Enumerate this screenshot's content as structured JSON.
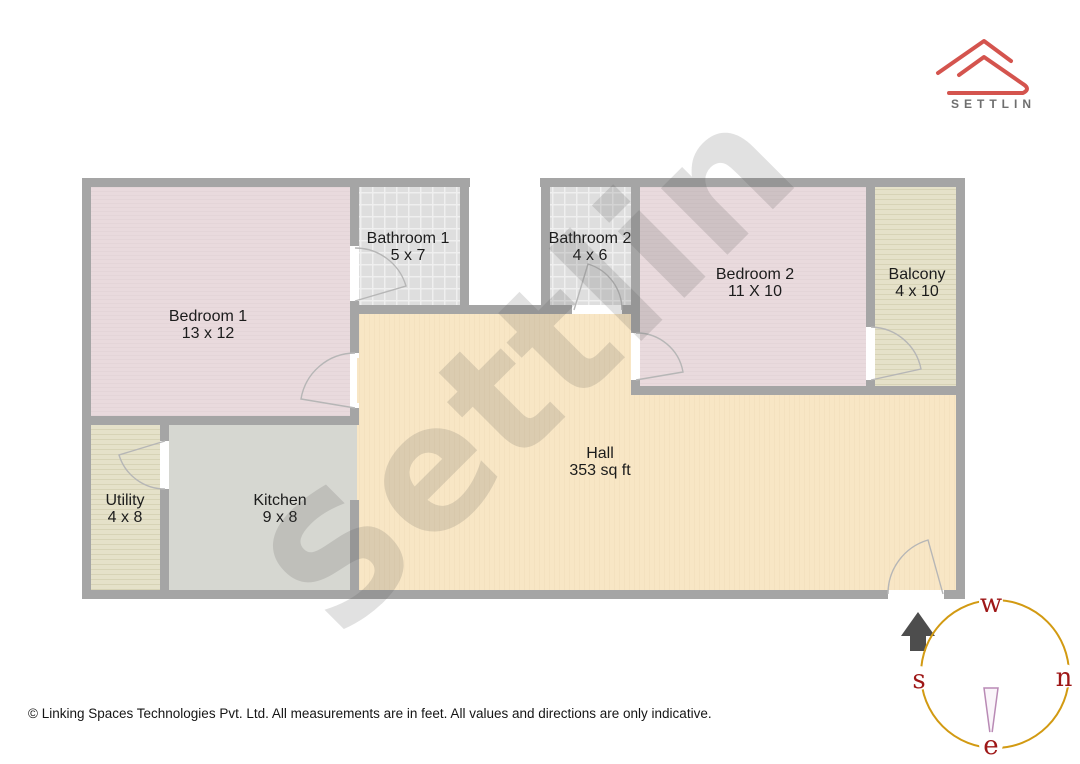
{
  "brand": {
    "name": "SETTLIN"
  },
  "watermark": {
    "text": "Settlin"
  },
  "floorplan": {
    "rooms": [
      {
        "name": "Bedroom 1",
        "dims": "13 x 12"
      },
      {
        "name": "Bathroom 1",
        "dims": "5 x 7"
      },
      {
        "name": "Bathroom 2",
        "dims": "4 x 6"
      },
      {
        "name": "Bedroom 2",
        "dims": "11 X 10"
      },
      {
        "name": "Balcony",
        "dims": "4 x 10"
      },
      {
        "name": "Utility",
        "dims": "4 x 8"
      },
      {
        "name": "Kitchen",
        "dims": "9 x 8"
      },
      {
        "name": "Hall",
        "dims": "353 sq ft"
      }
    ]
  },
  "compass": {
    "top": "w",
    "left": "s",
    "right": "n",
    "bottom": "e"
  },
  "footer": {
    "text": "© Linking Spaces Technologies Pvt. Ltd. All measurements are in feet. All values and directions are only indicative."
  },
  "colors": {
    "logo_red": "#d4544e",
    "brand_text_gray": "#6e6e6e",
    "wall_gray": "#a5a5a5",
    "bedroom_fill": "#e9dadd",
    "bathroom_fill": "#dedede",
    "balcony_utility_fill": "#e5e1c9",
    "kitchen_fill": "#d6d7d1",
    "hall_fill": "#f8e6c5",
    "door_arc_gray": "#b6b6b6",
    "compass_circle_gold": "#d29a12",
    "compass_letter_red": "#9e1717",
    "compass_needle_mauve": "#b98ab5",
    "entrance_arrow_gray": "#4d4d4d"
  }
}
